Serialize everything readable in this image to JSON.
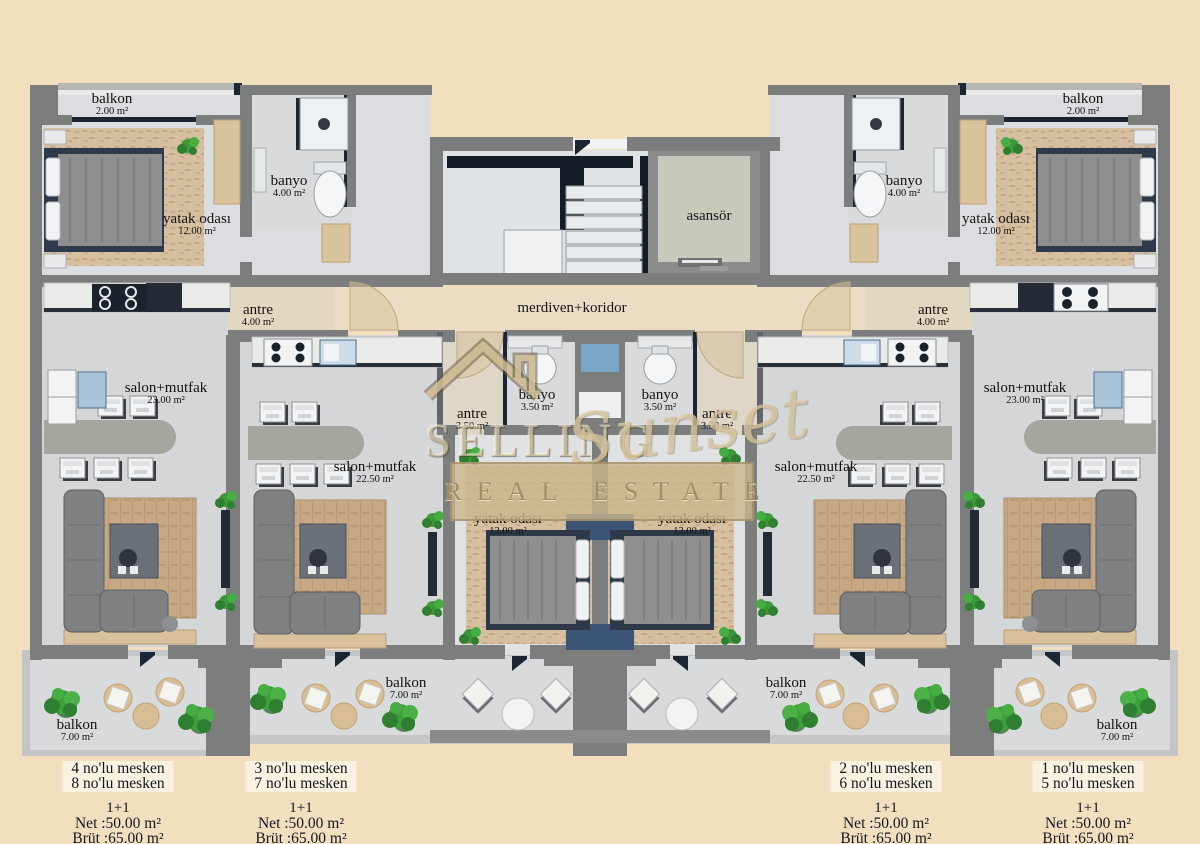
{
  "palette": {
    "background": "#f1dfbe",
    "wall_gray": "#7c7e7d",
    "accent_navy": "#1b2634",
    "floor_gray": "#d5d6d8",
    "corridor_beige": "#ecdcc3",
    "carpet_tan": "#d7c0a2",
    "skylight_blue": "#7aa7c7",
    "plant_green": "#3da03c",
    "watermark_tan": "#d6c09a"
  },
  "watermark": {
    "brand_top": "SELLING",
    "brand_script": "Sunset",
    "brand_bottom": "REAL ESTATE"
  },
  "core_labels": {
    "elevator": "asansör",
    "corridor": "merdiven+koridor"
  },
  "room_labels": [
    {
      "id": "balkon-top-left",
      "name": "balkon",
      "area": "2.00 m²"
    },
    {
      "id": "banyo-left",
      "name": "banyo",
      "area": "4.00 m²"
    },
    {
      "id": "yatak-odasi-left",
      "name": "yatak odası",
      "area": "12.00 m²"
    },
    {
      "id": "antre-left",
      "name": "antre",
      "area": "4.00 m²"
    },
    {
      "id": "salon-mutfak-outer-left",
      "name": "salon+mutfak",
      "area": "23.00 m²"
    },
    {
      "id": "salon-mutfak-inner-left",
      "name": "salon+mutfak",
      "area": "22.50 m²"
    },
    {
      "id": "antre-inner-left",
      "name": "antre",
      "area": "3.50 m²"
    },
    {
      "id": "banyo-inner-left",
      "name": "banyo",
      "area": "3.50 m²"
    },
    {
      "id": "banyo-inner-right",
      "name": "banyo",
      "area": "3.50 m²"
    },
    {
      "id": "antre-inner-right",
      "name": "antre",
      "area": "3.50 m²"
    },
    {
      "id": "yatak-odasi-center-left",
      "name": "yatak odası",
      "area": "13.00 m²"
    },
    {
      "id": "yatak-odasi-center-right",
      "name": "yatak odası",
      "area": "13.00 m²"
    },
    {
      "id": "salon-mutfak-inner-right",
      "name": "salon+mutfak",
      "area": "22.50 m²"
    },
    {
      "id": "salon-mutfak-outer-right",
      "name": "salon+mutfak",
      "area": "23.00 m²"
    },
    {
      "id": "antre-right",
      "name": "antre",
      "area": "4.00 m²"
    },
    {
      "id": "banyo-right",
      "name": "banyo",
      "area": "4.00 m²"
    },
    {
      "id": "yatak-odasi-right",
      "name": "yatak odası",
      "area": "12.00 m²"
    },
    {
      "id": "balkon-top-right",
      "name": "balkon",
      "area": "2.00 m²"
    },
    {
      "id": "balkon-bottom-left",
      "name": "balkon",
      "area": "7.00 m²"
    },
    {
      "id": "balkon-bottom-inner-left",
      "name": "balkon",
      "area": "7.00 m²"
    },
    {
      "id": "balkon-bottom-inner-right",
      "name": "balkon",
      "area": "7.00 m²"
    },
    {
      "id": "balkon-bottom-right",
      "name": "balkon",
      "area": "7.00 m²"
    }
  ],
  "units": [
    {
      "mesken_lines": [
        "4 no'lu mesken",
        "8 no'lu mesken"
      ],
      "plan_type": "1+1",
      "net": "Net :50.00 m²",
      "brut": "Brüt :65.00 m²"
    },
    {
      "mesken_lines": [
        "3 no'lu mesken",
        "7 no'lu mesken"
      ],
      "plan_type": "1+1",
      "net": "Net :50.00 m²",
      "brut": "Brüt :65.00 m²"
    },
    {
      "mesken_lines": [
        "2 no'lu mesken",
        "6 no'lu mesken"
      ],
      "plan_type": "1+1",
      "net": "Net :50.00 m²",
      "brut": "Brüt :65.00 m²"
    },
    {
      "mesken_lines": [
        "1 no'lu mesken",
        "5 no'lu mesken"
      ],
      "plan_type": "1+1",
      "net": "Net :50.00 m²",
      "brut": "Brüt :65.00 m²"
    }
  ]
}
